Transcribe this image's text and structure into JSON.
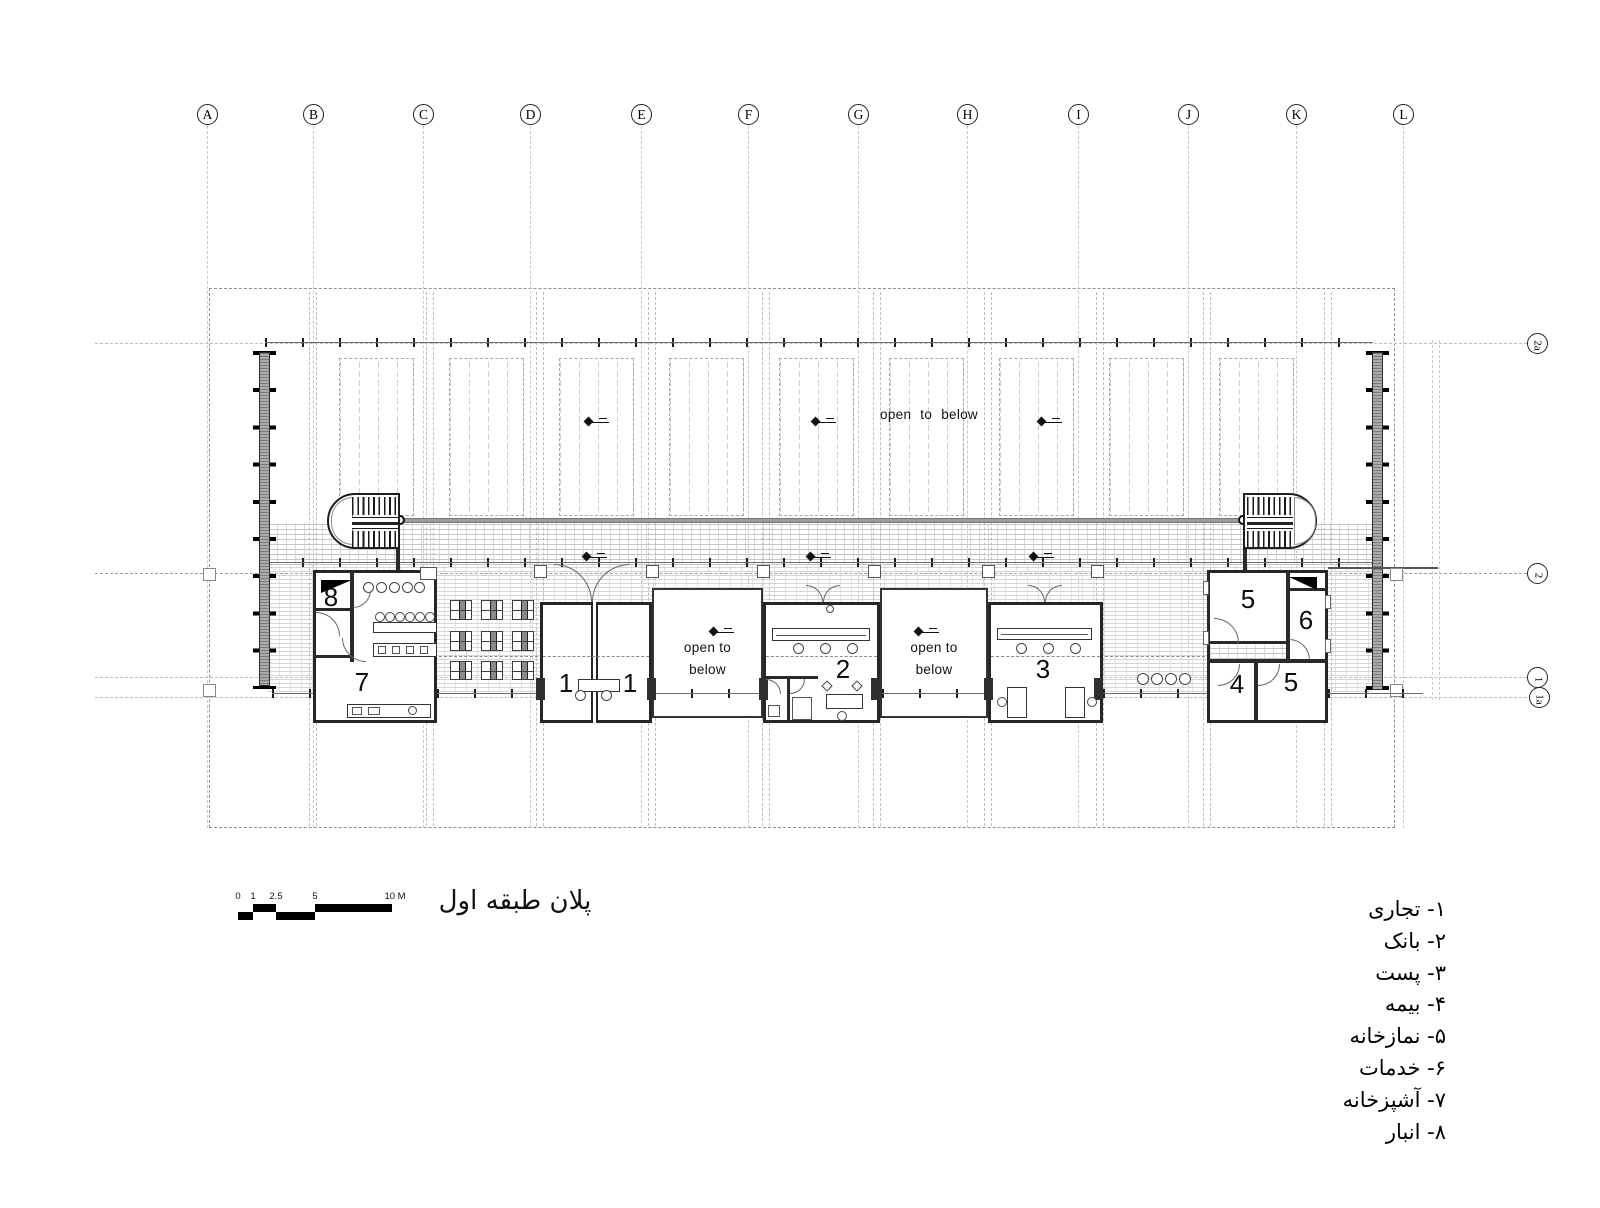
{
  "title": "پلان طبقه اول",
  "grid": {
    "columns": [
      "A",
      "B",
      "C",
      "D",
      "E",
      "F",
      "G",
      "H",
      "I",
      "J",
      "K",
      "L"
    ],
    "rows": [
      "2a",
      "2",
      "1",
      "1a"
    ]
  },
  "labels": {
    "open_to_below": "open to below",
    "open_line1": "open to",
    "open_line2": "below"
  },
  "rooms": {
    "r8": "8",
    "r7": "7",
    "r1a": "1",
    "r1b": "1",
    "r2": "2",
    "r3": "3",
    "r5top": "5",
    "r6": "6",
    "r4": "4",
    "r5bottom": "5"
  },
  "scale_bar": {
    "marks": [
      "0",
      "1",
      "2.5",
      "5",
      "10 M"
    ]
  },
  "legend": [
    "۱- تجاری",
    "۲- بانک",
    "۳- پست",
    "۴- بیمه",
    "۵- نمازخانه",
    "۶- خدمات",
    "۷- آشپزخانه",
    "۸- انبار"
  ]
}
